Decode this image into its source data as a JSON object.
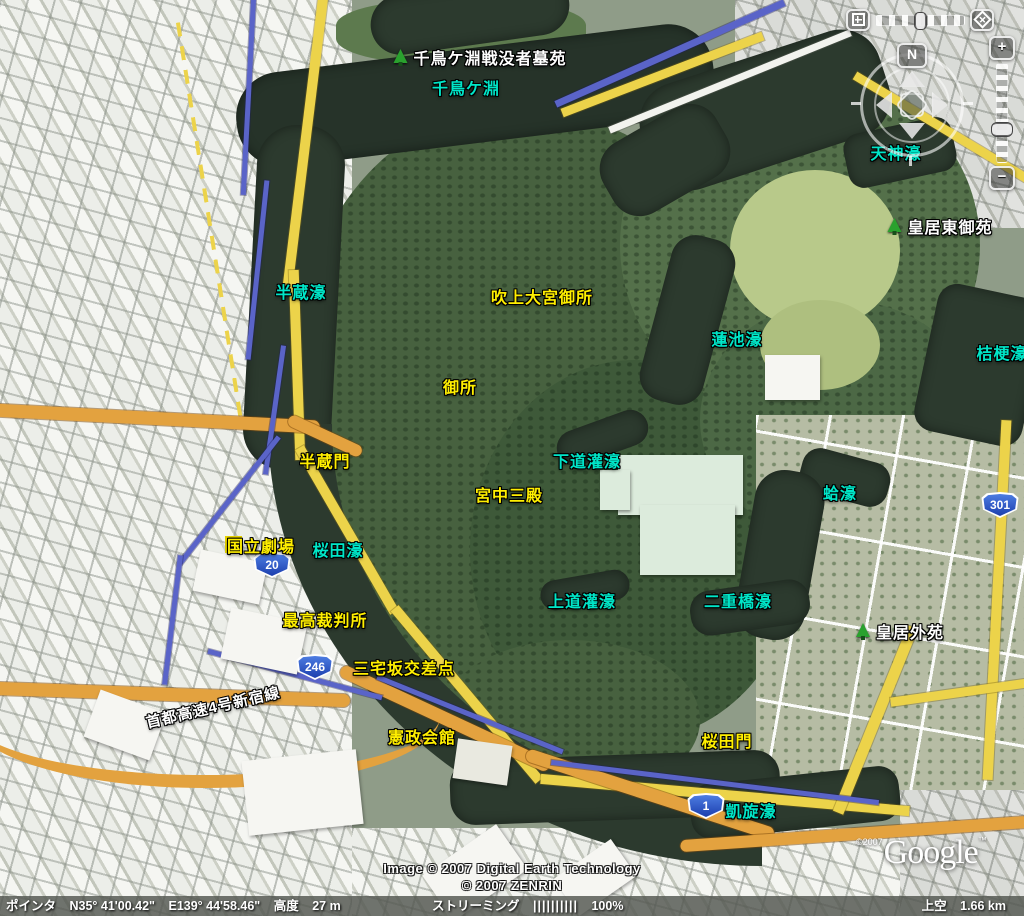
{
  "palette": {
    "water_label": "#00e6c8",
    "facility_label": "#ffef00",
    "park_label": "#ffffff",
    "road_yellow": "#ecd34a",
    "expressway_orange": "#e3a23f",
    "route_blue": "#5a64c8",
    "moat_water": "#2c3a2e"
  },
  "labels": [
    {
      "text": "千鳥ケ淵戦没者墓苑",
      "kind": "park"
    },
    {
      "text": "千鳥ケ淵",
      "kind": "water"
    },
    {
      "text": "天神濠",
      "kind": "water"
    },
    {
      "text": "皇居東御苑",
      "kind": "park"
    },
    {
      "text": "半蔵濠",
      "kind": "water"
    },
    {
      "text": "吹上大宮御所",
      "kind": "facility"
    },
    {
      "text": "蓮池濠",
      "kind": "water"
    },
    {
      "text": "桔梗濠",
      "kind": "water"
    },
    {
      "text": "御所",
      "kind": "facility"
    },
    {
      "text": "半蔵門",
      "kind": "facility"
    },
    {
      "text": "下道灌濠",
      "kind": "water"
    },
    {
      "text": "宮中三殿",
      "kind": "facility"
    },
    {
      "text": "蛤濠",
      "kind": "water"
    },
    {
      "text": "国立劇場",
      "kind": "facility"
    },
    {
      "text": "桜田濠",
      "kind": "water"
    },
    {
      "text": "最高裁判所",
      "kind": "facility"
    },
    {
      "text": "上道灌濠",
      "kind": "water"
    },
    {
      "text": "二重橋濠",
      "kind": "water"
    },
    {
      "text": "皇居外苑",
      "kind": "park"
    },
    {
      "text": "三宅坂交差点",
      "kind": "facility"
    },
    {
      "text": "首都高速4号新宿線",
      "kind": "road"
    },
    {
      "text": "憲政会館",
      "kind": "facility"
    },
    {
      "text": "桜田門",
      "kind": "facility"
    },
    {
      "text": "凱旋濠",
      "kind": "water"
    }
  ],
  "route_shields": [
    {
      "number": "20"
    },
    {
      "number": "246"
    },
    {
      "number": "1"
    },
    {
      "number": "301"
    }
  ],
  "controls": {
    "north": "N",
    "zoom_in": "+",
    "zoom_out": "−"
  },
  "status_bar": {
    "pointer_label": "ポインタ",
    "latitude": "N35° 41'00.42\"",
    "longitude": "E139° 44'58.46\"",
    "elevation_label": "高度",
    "elevation_value": "27 m",
    "streaming_label": "ストリーミング",
    "streaming_bars": "||||||||||",
    "streaming_percent": "100%",
    "altitude_label": "上空",
    "altitude_value": "1.66 km"
  },
  "attribution": {
    "line1": "Image © 2007 Digital Earth Technology",
    "line2": "© 2007 ZENRIN"
  },
  "logo": {
    "prefix": "©2007",
    "text": "Google",
    "tm": "™"
  }
}
